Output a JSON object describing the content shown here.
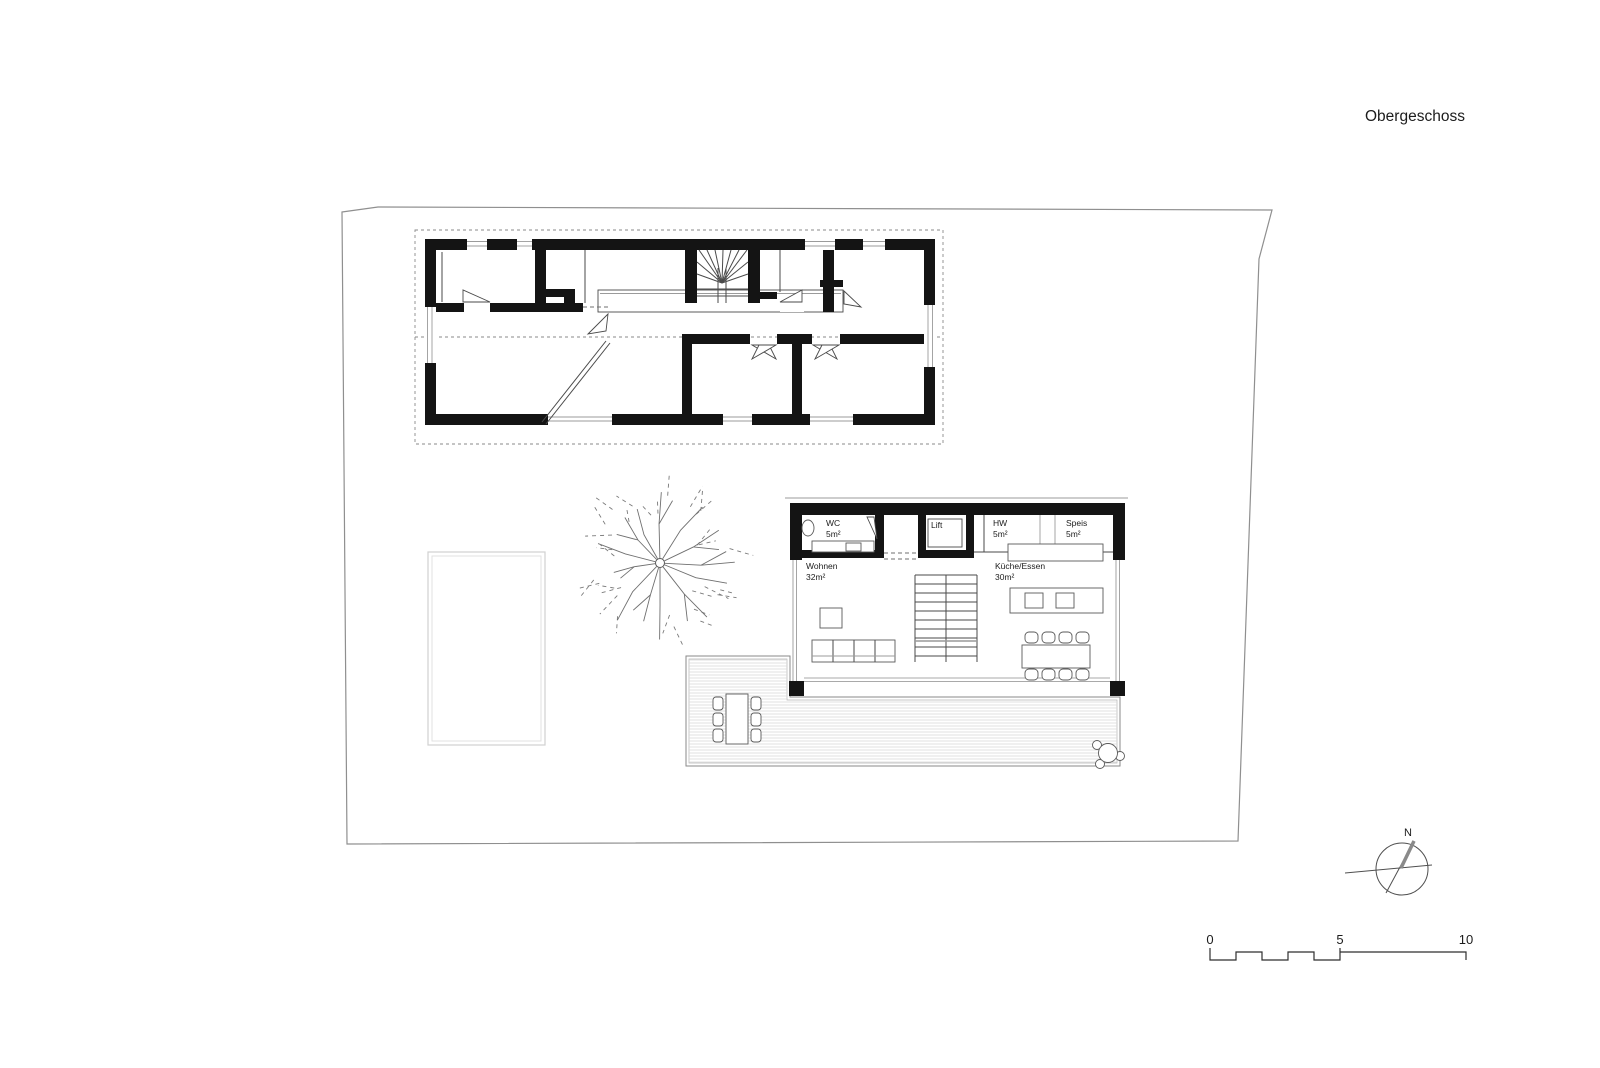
{
  "page": {
    "title": "Obergeschoss"
  },
  "ground_floor": {
    "rooms": {
      "wc": {
        "label": "WC",
        "area": "5m²"
      },
      "lift": {
        "label": "Lift",
        "area": ""
      },
      "hw": {
        "label": "HW",
        "area": "5m²"
      },
      "speis": {
        "label": "Speis",
        "area": "5m²"
      },
      "wohnen": {
        "label": "Wohnen",
        "area": "32m²"
      },
      "kueche_essen": {
        "label": "Küche/Essen",
        "area": "30m²"
      }
    }
  },
  "compass": {
    "north_label": "N"
  },
  "scale_bar": {
    "tick_0": "0",
    "tick_5": "5",
    "tick_10": "10"
  },
  "colors": {
    "wall": "#141414",
    "thin_line": "#4a4a4a",
    "boundary": "#8f8f8f",
    "deck_stripe": "#d9d9d9"
  }
}
